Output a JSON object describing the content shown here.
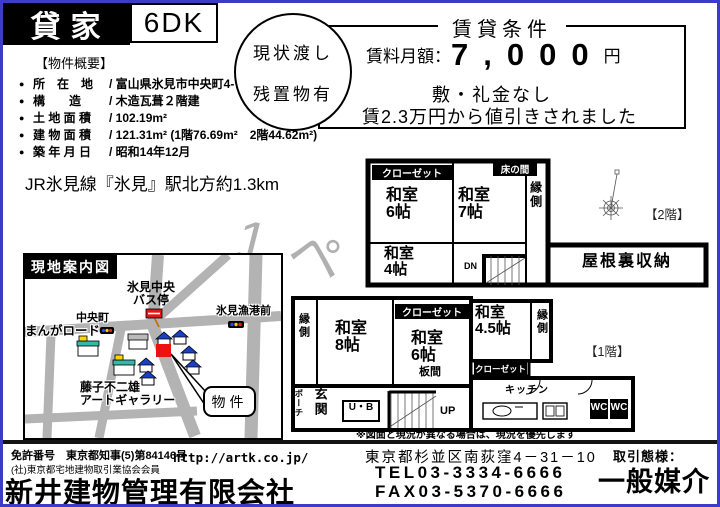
{
  "page": {
    "watermark": "1 ペ"
  },
  "header": {
    "property_type": "貸家",
    "layout": "6DK",
    "handover_line1": "現状渡し",
    "handover_line2": "残置物有",
    "rental_terms": {
      "title": "賃貸条件",
      "rent_label": "賃料月額：",
      "rent_value": "7,000",
      "rent_unit": "円",
      "deposit_note": "敷・礼金なし",
      "discount_note": "賃2.3万円から値引きされました"
    }
  },
  "overview": {
    "title": "【物件概要】",
    "rows": [
      {
        "bullet": "●",
        "label": "所　在　地",
        "value": "/ 富山県氷見市中央町4-7"
      },
      {
        "bullet": "●",
        "label": "構　　造",
        "value": "/ 木造瓦葺２階建"
      },
      {
        "bullet": "●",
        "label": "土 地 面 積",
        "value": "/ 102.19m²"
      },
      {
        "bullet": "●",
        "label": "建 物 面 積",
        "value": "/ 121.31m² (1階76.69m²　2階44.62m²)"
      },
      {
        "bullet": "●",
        "label": "築 年 月 日",
        "value": "/ 昭和14年12月"
      }
    ]
  },
  "access": "JR氷見線『氷見』駅北方約1.3km",
  "map": {
    "title": "現地案内図",
    "bus_stop": "氷見中央\nバス停",
    "fishing_port": "氷見漁港前",
    "chuo_machi": "中央町",
    "manga_road": "まんがロード",
    "gallery": "藤子不二雄\nアートギャラリー",
    "property_callout": "物件"
  },
  "floor2": {
    "caption": "【2階】",
    "closet": "クローゼット",
    "tokonoma": "床の間",
    "washitsu6": "和室\n6帖",
    "washitsu7": "和室\n7帖",
    "washitsu4": "和室\n4帖",
    "engawa": "縁側",
    "dn": "DN",
    "attic": "屋根裏収納"
  },
  "floor1": {
    "caption": "【1階】",
    "engawa_left": "縁側",
    "washitsu8": "和室\n8帖",
    "closet_top": "クローゼット",
    "washitsu6": "和室\n6帖",
    "itanoma": "板間",
    "washitsu45": "和室\n4.5帖",
    "engawa_right": "縁側",
    "closet_bottom": "クローゼット",
    "porch": "ポーチ",
    "genkan": "玄関",
    "ub": "U・B",
    "up": "UP",
    "kitchen": "キッチン",
    "wc1": "WC",
    "wc2": "WC"
  },
  "note": "※図面と現況が異なる場合は、現況を優先します",
  "footer": {
    "license_no": "免許番号　東京都知事(5)第84146号",
    "association": "(社)東京都宅地建物取引業協会会員",
    "company": "新井建物管理有限会社",
    "url": "http://artk.co.jp/",
    "address": "東京都杉並区南荻窪4－31－10",
    "tel": "TEL03-3334-6666",
    "fax": "FAX03-5370-6666",
    "dealing_type_label": "取引態様：",
    "dealing_type": "一般媒介"
  }
}
